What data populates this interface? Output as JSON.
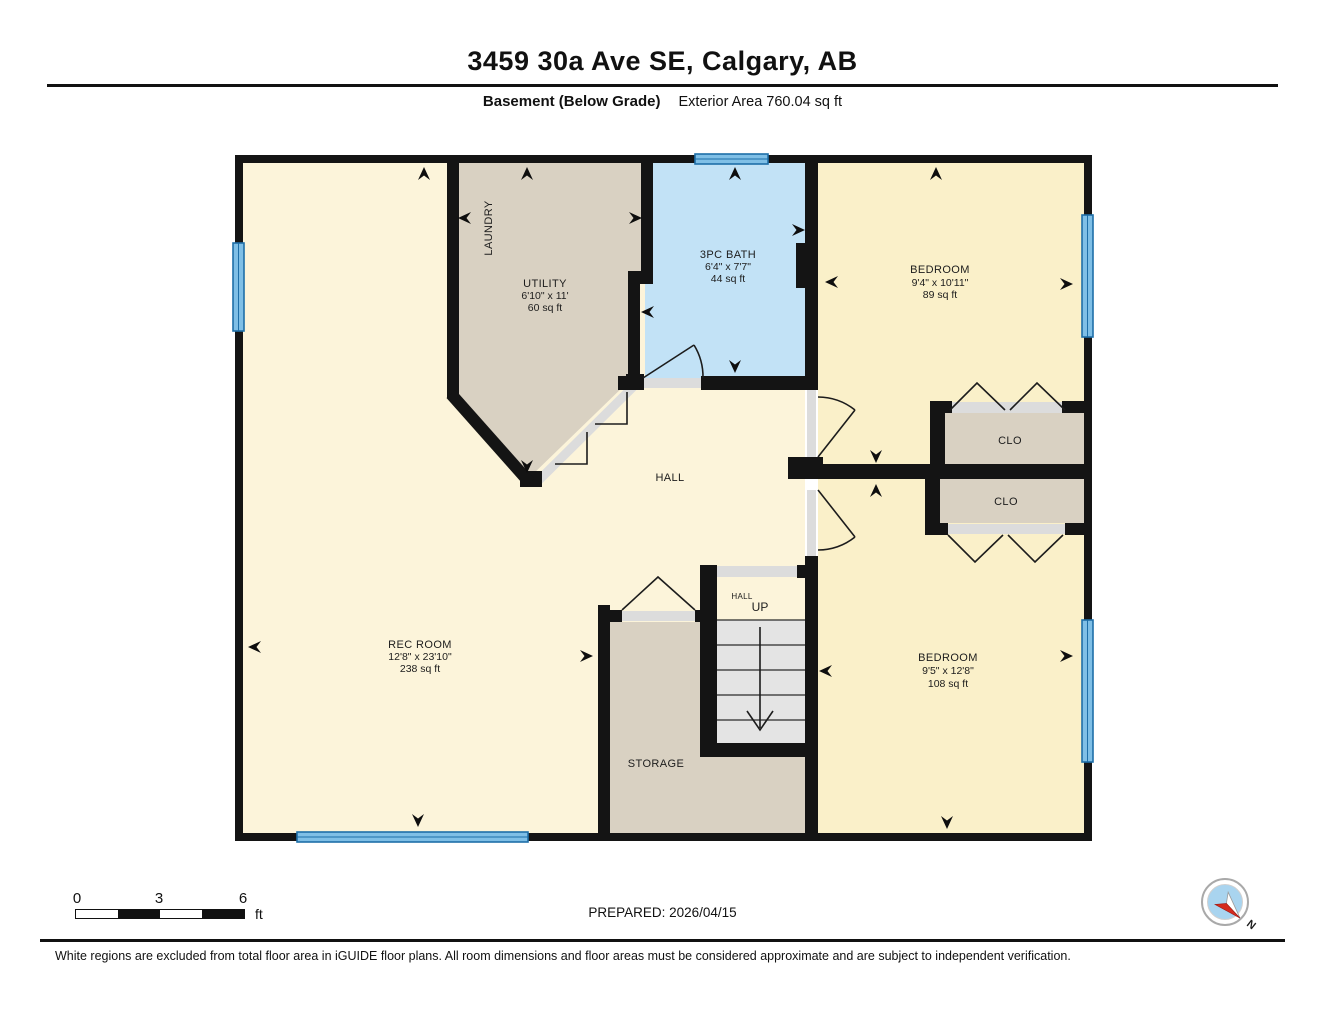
{
  "title": "3459 30a Ave SE, Calgary, AB",
  "subtitle": {
    "floor": "Basement (Below Grade)",
    "area_label": "Exterior Area 760.04 sq ft"
  },
  "rooms": {
    "laundry": {
      "name": "LAUNDRY"
    },
    "utility": {
      "name": "UTILITY",
      "dims": "6'10\" x 11'",
      "area": "60 sq ft"
    },
    "bath": {
      "name": "3PC BATH",
      "dims": "6'4\" x 7'7\"",
      "area": "44 sq ft"
    },
    "bedroom_top": {
      "name": "BEDROOM",
      "dims": "9'4\" x 10'11\"",
      "area": "89 sq ft"
    },
    "bedroom_bottom": {
      "name": "BEDROOM",
      "dims": "9'5\" x 12'8\"",
      "area": "108 sq ft"
    },
    "rec_room": {
      "name": "REC ROOM",
      "dims": "12'8\" x 23'10\"",
      "area": "238 sq ft"
    },
    "hall": {
      "name": "HALL"
    },
    "stair_hall": {
      "name": "HALL",
      "up": "UP"
    },
    "storage": {
      "name": "STORAGE"
    },
    "closet_top": {
      "name": "CLO"
    },
    "closet_bottom": {
      "name": "CLO"
    }
  },
  "scale_bar": {
    "ticks": [
      "0",
      "3",
      "6"
    ],
    "unit": "ft"
  },
  "prepared": "PREPARED: 2026/04/15",
  "compass": {
    "north_label": "N"
  },
  "disclaimer": "White regions are excluded from total floor area in iGUIDE floor plans. All room dimensions and floor areas must be considered approximate and are subject to independent verification.",
  "colors": {
    "wall": "#141414",
    "room_cream": "#FCF4DA",
    "bedroom_cream": "#FAF0C9",
    "room_tan": "#D9D1C2",
    "bath_blue": "#C2E2F6",
    "window_blue": "#7FBFE6",
    "window_frame_blue": "#1E6FA8",
    "door_jamb_gray": "#DCDCDC",
    "stair_tread_gray": "#E4E4E4",
    "compass_red": "#D42B1E"
  }
}
